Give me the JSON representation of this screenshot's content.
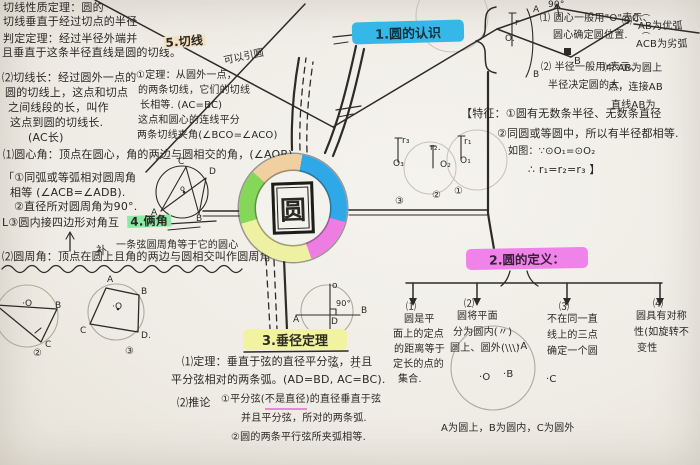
{
  "page": {
    "background": "#efece5",
    "ink": "#2e2b27"
  },
  "center": {
    "label": "圆",
    "ring_colors": [
      "#2fa8e8",
      "#ee7ce2",
      "#eef0a2",
      "#85d75a",
      "#f0cfa0"
    ]
  },
  "nodes": {
    "sec1": {
      "title": "1.圆的认识",
      "color": "#35b7e8"
    },
    "sec2": {
      "title": "2.圆的定义：",
      "color": "#ef83ea"
    },
    "sec3": {
      "title": "3.垂径定理",
      "color": "#f1f3a0"
    }
  },
  "annotations": [
    {
      "n": "tangent-prop-line1",
      "x": 3,
      "y": 2,
      "t": "切线性质定理：圆的"
    },
    {
      "n": "tangent-prop-line2",
      "x": 3,
      "y": 16,
      "t": "切线垂直于经过切点的半径"
    },
    {
      "n": "judge-thm-line1",
      "x": 3,
      "y": 33,
      "t": "判定定理：经过半径外端并"
    },
    {
      "n": "judge-thm-line2",
      "x": 2,
      "y": 47,
      "t": "且垂直于这条半径直线是圆的切线。"
    },
    {
      "n": "sec5-title",
      "x": 163,
      "y": 37,
      "t": "5.切线",
      "s": 12,
      "rot": -4,
      "cls": "hl-tan"
    },
    {
      "n": "tangent-len-line1",
      "x": 2,
      "y": 72,
      "t": "⑵切线长：经过圆外一点的"
    },
    {
      "n": "tangent-len-line2",
      "x": 5,
      "y": 87,
      "t": "圆的切线上，这点和切点"
    },
    {
      "n": "tangent-len-line3",
      "x": 8,
      "y": 102,
      "t": "之间线段的长，叫作"
    },
    {
      "n": "tangent-len-line4",
      "x": 10,
      "y": 117,
      "t": "这点到圆的切线长."
    },
    {
      "n": "tangent-len-line5",
      "x": 28,
      "y": 132,
      "t": "(AC长)"
    },
    {
      "n": "tangent-thm-note",
      "x": 223,
      "y": 57,
      "t": "可以引圆",
      "s": 10,
      "rot": -12
    },
    {
      "n": "tangent-thm-line1",
      "x": 136,
      "y": 71,
      "t": "①定理：从圆外一点，",
      "s": 10
    },
    {
      "n": "tangent-thm-line2",
      "x": 138,
      "y": 86,
      "t": "的两条切线，它们的切线",
      "s": 10
    },
    {
      "n": "tangent-thm-line3",
      "x": 140,
      "y": 101,
      "t": "长相等. (AC=BC)",
      "s": 10
    },
    {
      "n": "tangent-thm-line4",
      "x": 138,
      "y": 116,
      "t": "这点和圆心的连线平分",
      "s": 10
    },
    {
      "n": "tangent-thm-line5",
      "x": 137,
      "y": 131,
      "t": "两条切线夹角(∠BCO=∠ACO)",
      "s": 10
    },
    {
      "n": "central-angle-def",
      "x": 3,
      "y": 149,
      "t": "⑴圆心角：顶点在圆心，角的两边与圆相交的角，(∠AOB)."
    },
    {
      "n": "inscribed-thm-line1",
      "x": 3,
      "y": 172,
      "t": "「①同弧或等弧相对圆周角"
    },
    {
      "n": "inscribed-thm-line2",
      "x": 10,
      "y": 187,
      "t": "相等 (∠ACB=∠ADB)."
    },
    {
      "n": "inscribed-thm-line3",
      "x": 14,
      "y": 201,
      "t": "②直径所对圆周角为90°."
    },
    {
      "n": "inscribed-thm-line4",
      "x": 2,
      "y": 217,
      "t": "L③圆内接四边形对角互"
    },
    {
      "n": "sec4-title",
      "x": 127,
      "y": 216,
      "t": "4.俩角",
      "s": 12,
      "rot": -2,
      "cls": "hl-green"
    },
    {
      "n": "bu-correction",
      "x": 96,
      "y": 245,
      "t": "补"
    },
    {
      "n": "inscribed-half-thm",
      "x": 116,
      "y": 241,
      "t": "一条弦圆周角等于它的圆心",
      "s": 10
    },
    {
      "n": "peripheral-angle-def",
      "x": 2,
      "y": 251,
      "t": "⑵圆周角：顶点在圆上且角的两边与圆相交叫作圆周角"
    },
    {
      "n": "fig2-label-O",
      "x": 22,
      "y": 300,
      "t": "·O",
      "s": 9
    },
    {
      "n": "fig2-label-B",
      "x": 55,
      "y": 302,
      "t": "B",
      "s": 9
    },
    {
      "n": "fig2-label-C",
      "x": 45,
      "y": 341,
      "t": "C",
      "s": 9
    },
    {
      "n": "fig2-num",
      "x": 33,
      "y": 349,
      "t": "②",
      "s": 10
    },
    {
      "n": "fig3-label-A",
      "x": 107,
      "y": 276,
      "t": "A",
      "s": 9
    },
    {
      "n": "fig3-label-B",
      "x": 141,
      "y": 288,
      "t": "B",
      "s": 9
    },
    {
      "n": "fig3-label-O",
      "x": 112,
      "y": 303,
      "t": "·O",
      "s": 9
    },
    {
      "n": "fig3-label-C",
      "x": 80,
      "y": 327,
      "t": "C",
      "s": 9
    },
    {
      "n": "fig3-label-D",
      "x": 141,
      "y": 332,
      "t": "D.",
      "s": 9
    },
    {
      "n": "fig3-num",
      "x": 125,
      "y": 347,
      "t": "③",
      "s": 10
    },
    {
      "n": "figIA-label-C",
      "x": 178,
      "y": 158,
      "t": "C",
      "s": 9
    },
    {
      "n": "figIA-label-D",
      "x": 209,
      "y": 168,
      "t": "D",
      "s": 9
    },
    {
      "n": "figIA-label-A",
      "x": 151,
      "y": 209,
      "t": "A",
      "s": 9
    },
    {
      "n": "figIA-label-B",
      "x": 196,
      "y": 215,
      "t": "B",
      "s": 9
    },
    {
      "n": "figIA-label-O",
      "x": 180,
      "y": 185,
      "t": "o",
      "s": 8
    },
    {
      "n": "kite-angle-label",
      "x": 548,
      "y": 1,
      "t": "90°",
      "s": 9
    },
    {
      "n": "kite-label-C",
      "x": 632,
      "y": 14,
      "t": "C",
      "s": 10
    },
    {
      "n": "kite-label-B",
      "x": 574,
      "y": 57,
      "t": "B",
      "s": 10
    },
    {
      "n": "sec1-fig-r",
      "x": 515,
      "y": 19,
      "t": "r",
      "s": 9
    },
    {
      "n": "sec1-fig-O",
      "x": 505,
      "y": 35,
      "t": "O.",
      "s": 9
    },
    {
      "n": "sec1-fig-A",
      "x": 533,
      "y": 6,
      "t": "A",
      "s": 9
    },
    {
      "n": "sec1-fig-B",
      "x": 533,
      "y": 71,
      "t": "B",
      "s": 9
    },
    {
      "n": "sec1-item1a",
      "x": 540,
      "y": 14,
      "t": "⑴ 圆心一般用\"O\"表示、",
      "s": 10
    },
    {
      "n": "sec1-item1b",
      "x": 553,
      "y": 31,
      "t": "圆心确定圆位置.",
      "s": 10
    },
    {
      "n": "sec1-item3-num",
      "x": 622,
      "y": 17,
      "t": "⑶",
      "s": 10
    },
    {
      "n": "sec1-item3a-arc",
      "x": 642,
      "y": 15,
      "t": "⌒",
      "s": 8
    },
    {
      "n": "sec1-item3a",
      "x": 638,
      "y": 22,
      "t": "AB为优弧",
      "s": 10
    },
    {
      "n": "sec1-item3b-arc",
      "x": 642,
      "y": 33,
      "t": "⌒",
      "s": 8
    },
    {
      "n": "sec1-item3b",
      "x": 636,
      "y": 40,
      "t": "ACB为劣弧",
      "s": 10
    },
    {
      "n": "sec1-item2a",
      "x": 541,
      "y": 63,
      "t": "⑵ 半径一般用r表示、",
      "s": 10
    },
    {
      "n": "sec1-item2b",
      "x": 548,
      "y": 81,
      "t": "半径决定圆的大.",
      "s": 10
    },
    {
      "n": "sec1-item4a",
      "x": 604,
      "y": 64,
      "t": "⑷ AB为圆上",
      "s": 10
    },
    {
      "n": "sec1-item4b",
      "x": 608,
      "y": 83,
      "t": "点，连接AB",
      "s": 10
    },
    {
      "n": "sec1-item4c",
      "x": 611,
      "y": 101,
      "t": "直线AB为",
      "s": 10
    },
    {
      "n": "sec1-feat1",
      "x": 461,
      "y": 108,
      "t": "【特征：①圆有无数条半径、无数条直径"
    },
    {
      "n": "sec1-feat2",
      "x": 497,
      "y": 128,
      "t": "②同圆或等圆中，所以有半径都相等."
    },
    {
      "n": "sec1-feat3",
      "x": 508,
      "y": 147,
      "t": "如图：∵⊙O₁=⊙O₂",
      "s": 10
    },
    {
      "n": "sec1-feat4",
      "x": 528,
      "y": 164,
      "t": "∴ r₁=r₂=r₃ 】",
      "s": 11
    },
    {
      "n": "rfig3-r",
      "x": 402,
      "y": 137,
      "t": "r₃",
      "s": 9
    },
    {
      "n": "rfig3-o",
      "x": 393,
      "y": 160,
      "t": "O₃",
      "s": 9
    },
    {
      "n": "rfig2-r",
      "x": 430,
      "y": 144,
      "t": "r₂.",
      "s": 9
    },
    {
      "n": "rfig2-o",
      "x": 440,
      "y": 161,
      "t": "O₂",
      "s": 9
    },
    {
      "n": "rfig1-r",
      "x": 464,
      "y": 138,
      "t": "r₁",
      "s": 9
    },
    {
      "n": "rfig1-o",
      "x": 460,
      "y": 157,
      "t": "O₁",
      "s": 9
    },
    {
      "n": "rfig-num3",
      "x": 395,
      "y": 197,
      "t": "③",
      "s": 10
    },
    {
      "n": "rfig-num2",
      "x": 432,
      "y": 191,
      "t": "②",
      "s": 10
    },
    {
      "n": "rfig-num1",
      "x": 454,
      "y": 187,
      "t": "①",
      "s": 10
    },
    {
      "n": "sec2-col1-num",
      "x": 406,
      "y": 303,
      "t": "⑴",
      "s": 10
    },
    {
      "n": "sec2-col1-line1",
      "x": 404,
      "y": 315,
      "t": "圆是平",
      "s": 10
    },
    {
      "n": "sec2-col1-line2",
      "x": 393,
      "y": 330,
      "t": "面上的定点",
      "s": 10
    },
    {
      "n": "sec2-col1-line3",
      "x": 394,
      "y": 345,
      "t": "的距离等于",
      "s": 10
    },
    {
      "n": "sec2-col1-line4",
      "x": 393,
      "y": 360,
      "t": "定长的点的",
      "s": 10
    },
    {
      "n": "sec2-col1-line5",
      "x": 398,
      "y": 375,
      "t": "集合.",
      "s": 10
    },
    {
      "n": "sec2-col2-num",
      "x": 464,
      "y": 300,
      "t": "⑵",
      "s": 10
    },
    {
      "n": "sec2-col2-line1",
      "x": 457,
      "y": 312,
      "t": "圆将平面",
      "s": 10
    },
    {
      "n": "sec2-col2-line2",
      "x": 453,
      "y": 328,
      "t": "分为圆内(〃)",
      "s": 10
    },
    {
      "n": "sec2-col2-line3",
      "x": 450,
      "y": 344,
      "t": "圆上、圆外(\\\\\\)",
      "s": 10
    },
    {
      "n": "sec2-col3-num",
      "x": 559,
      "y": 303,
      "t": "⑶",
      "s": 10
    },
    {
      "n": "sec2-col3-line1",
      "x": 547,
      "y": 315,
      "t": "不在同一直",
      "s": 10
    },
    {
      "n": "sec2-col3-line2",
      "x": 547,
      "y": 331,
      "t": "线上的三点",
      "s": 10
    },
    {
      "n": "sec2-col3-line3",
      "x": 547,
      "y": 347,
      "t": "确定一个圆",
      "s": 10
    },
    {
      "n": "sec2-col4-num",
      "x": 653,
      "y": 300,
      "t": "⑷",
      "s": 10
    },
    {
      "n": "sec2-col4-line1",
      "x": 636,
      "y": 312,
      "t": "圆具有对称",
      "s": 10
    },
    {
      "n": "sec2-col4-line2",
      "x": 634,
      "y": 328,
      "t": "性(如旋转不",
      "s": 10
    },
    {
      "n": "sec2-col4-line3",
      "x": 637,
      "y": 344,
      "t": "变性",
      "s": 10
    },
    {
      "n": "sec2-fig-O",
      "x": 479,
      "y": 373,
      "t": "·O",
      "s": 10
    },
    {
      "n": "sec2-fig-B",
      "x": 503,
      "y": 370,
      "t": "·B",
      "s": 10
    },
    {
      "n": "sec2-fig-A",
      "x": 517,
      "y": 342,
      "t": "·A",
      "s": 10
    },
    {
      "n": "sec2-fig-C",
      "x": 546,
      "y": 375,
      "t": "·C",
      "s": 10
    },
    {
      "n": "sec2-caption",
      "x": 441,
      "y": 424,
      "t": "A为圆上，B为圆内，C为圆外",
      "s": 10
    },
    {
      "n": "vd-fig-o",
      "x": 332,
      "y": 282,
      "t": "o",
      "s": 9
    },
    {
      "n": "vd-fig-angle",
      "x": 336,
      "y": 300,
      "t": "90°",
      "s": 8
    },
    {
      "n": "vd-fig-A",
      "x": 293,
      "y": 316,
      "t": "A",
      "s": 9
    },
    {
      "n": "vd-fig-B",
      "x": 361,
      "y": 307,
      "t": "B",
      "s": 9
    },
    {
      "n": "vd-fig-D",
      "x": 331,
      "y": 318,
      "t": "D",
      "s": 9
    },
    {
      "n": "vd-fig-C",
      "x": 324,
      "y": 333,
      "t": "C",
      "s": 9
    },
    {
      "n": "vd-line1",
      "x": 182,
      "y": 356,
      "t": "⑴定理：垂直于弦的直径平分弦，并且"
    },
    {
      "n": "vd-line2",
      "x": 171,
      "y": 374,
      "t": "平分弦相对的两条弧。(AD=BD, AC=BC)."
    },
    {
      "n": "vd-arc1",
      "x": 331,
      "y": 367,
      "t": "⌒",
      "s": 8
    },
    {
      "n": "vd-arc2",
      "x": 352,
      "y": 367,
      "t": "⌒",
      "s": 8
    },
    {
      "n": "vd-line3a",
      "x": 177,
      "y": 397,
      "t": "⑵推论"
    },
    {
      "n": "vd-line3b",
      "x": 221,
      "y": 395,
      "t": "①平分弦(不是直径)的直径垂直于弦",
      "s": 10
    },
    {
      "n": "vd-line4",
      "x": 241,
      "y": 414,
      "t": "并且平分弦，所对的两条弧.",
      "s": 10
    },
    {
      "n": "vd-line5",
      "x": 231,
      "y": 433,
      "t": "②圆的两条平行弦所夹弧相等.",
      "s": 10
    }
  ]
}
